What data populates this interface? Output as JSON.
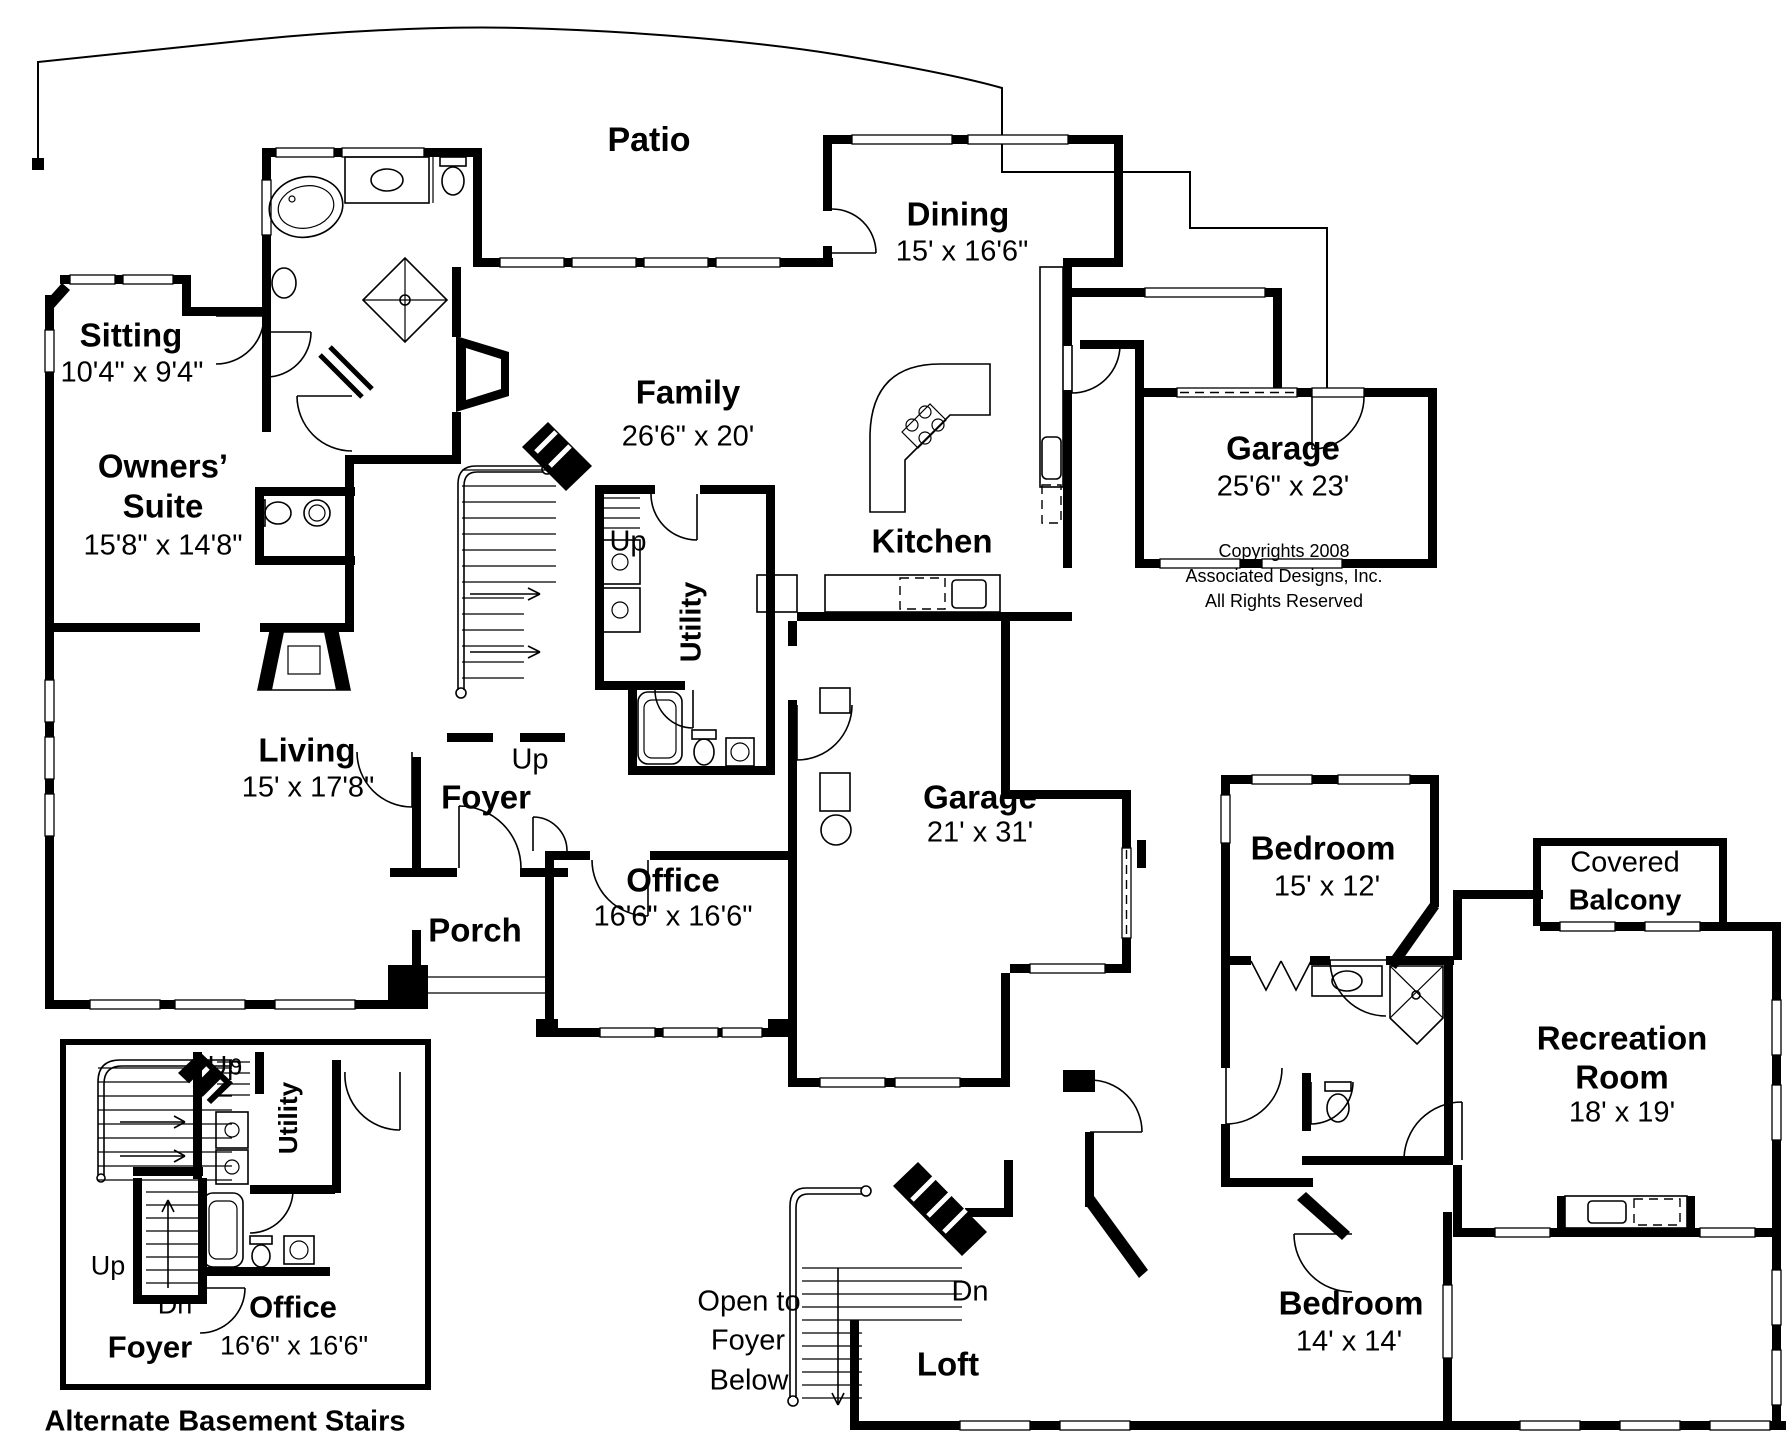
{
  "plan": {
    "colors": {
      "ink": "#000000",
      "paper": "#ffffff"
    },
    "ff": {
      "patio": "Patio",
      "sitting": {
        "name": "Sitting",
        "dims": "10'4\" x 9'4\""
      },
      "owners": {
        "l1": "Owners’",
        "l2": "Suite",
        "dims": "15'8\" x 14'8\""
      },
      "family": {
        "name": "Family",
        "dims": "26'6\" x 20'"
      },
      "dining": {
        "name": "Dining",
        "dims": "15' x 16'6\""
      },
      "kitchen": "Kitchen",
      "utility": "Utility",
      "garage_rear": {
        "name": "Garage",
        "dims": "25'6\" x 23'"
      },
      "garage_main": {
        "name": "Garage",
        "dims": "21' x 31'"
      },
      "living": {
        "name": "Living",
        "dims": "15' x 17'8\""
      },
      "office": {
        "name": "Office",
        "dims": "16'6\" x 16'6\""
      },
      "foyer": "Foyer",
      "porch": "Porch",
      "up_stairs": "Up",
      "up_foyer": "Up"
    },
    "sf": {
      "bedroom_front": {
        "name": "Bedroom",
        "dims": "15' x 12'"
      },
      "balcony": {
        "l1": "Covered",
        "l2": "Balcony"
      },
      "recreation": {
        "l1": "Recreation",
        "l2": "Room",
        "dims": "18' x 19'"
      },
      "bedroom_rear": {
        "name": "Bedroom",
        "dims": "14' x 14'"
      },
      "loft": "Loft",
      "dn": "Dn",
      "open_to": {
        "l1": "Open to",
        "l2": "Foyer",
        "l3": "Below"
      }
    },
    "inset": {
      "up_top": "Up",
      "utility": "Utility",
      "up_side": "Up",
      "dn": "Dn",
      "foyer": "Foyer",
      "office": {
        "name": "Office",
        "dims": "16'6\" x 16'6\""
      },
      "caption": "Alternate Basement Stairs"
    },
    "copyright": {
      "l1": "Copyrights 2008",
      "l2": "Associated Designs, Inc.",
      "l3": "All Rights Reserved"
    }
  }
}
